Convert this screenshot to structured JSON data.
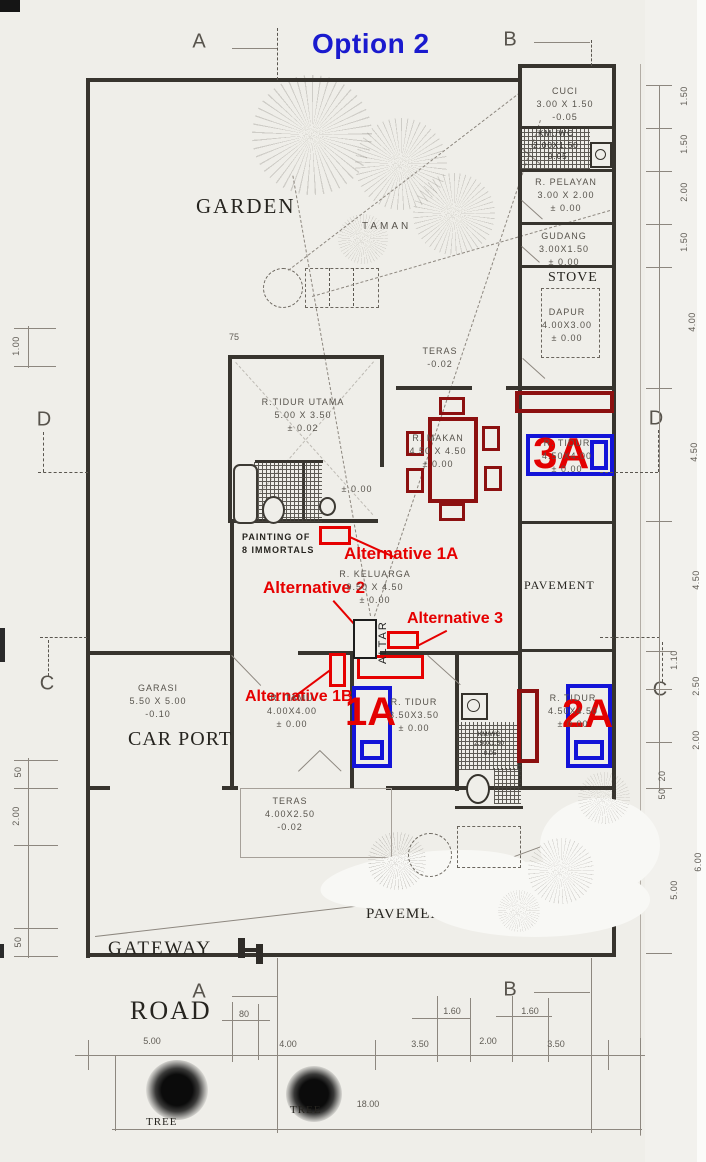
{
  "title": "Option 2",
  "grid": {
    "a_top": "A",
    "b_top": "B",
    "d_left": "D",
    "d_right": "D",
    "c_left": "C",
    "c_right": "C",
    "a_bottom": "A",
    "b_bottom": "B"
  },
  "areas": {
    "garden": "GARDEN",
    "taman": "TAMAN",
    "stove": "STOVE",
    "car_port": "CAR PORT",
    "pavement_right": "PAVEMENT",
    "pavement_bottom": "PAVEMENT",
    "gateway": "GATEWAY",
    "road": "ROAD",
    "tree_1": "TREE",
    "tree_2": "TREE"
  },
  "rooms": {
    "cuci": [
      "CUCI",
      "3.00 X 1.50",
      "-0.05"
    ],
    "kmwc_top": [
      "KM./WC",
      "2.00X1.50",
      "-0.05"
    ],
    "pelayan": [
      "R. PELAYAN",
      "3.00 X 2.00",
      "± 0.00"
    ],
    "gudang": [
      "GUDANG",
      "3.00X1.50",
      "± 0.00"
    ],
    "dapur": [
      "DAPUR",
      "4.00X3.00",
      "± 0.00"
    ],
    "teras_top": [
      "TERAS",
      "-0.02"
    ],
    "tidur_utama": [
      "R.TIDUR UTAMA",
      "5.00 X 3.50",
      "± 0.02"
    ],
    "makan": [
      "R. MAKAN",
      "4.50 X 4.50",
      "± 0.00"
    ],
    "tidur_3a": [
      "R. TIDUR",
      "4.50X4.00",
      "± 0.00"
    ],
    "keluarga": [
      "R. KELUARGA",
      "9.50 X 4.50",
      "± 0.00"
    ],
    "garasi": [
      "GARASI",
      "5.50 X 5.00",
      "-0.10"
    ],
    "tamu": [
      "R. TAMU",
      "4.00X4.00",
      "± 0.00"
    ],
    "tidur_1a": [
      "R. TIDUR",
      "3.50X3.50",
      "± 0.00"
    ],
    "tidur_2a": [
      "R. TIDUR",
      "4.50X4.50",
      "± 0.00"
    ],
    "teras_bottom": [
      "TERAS",
      "4.00X2.50",
      "-0.02"
    ],
    "kmwc_mid": [
      "KM/WC",
      "2.50X1.50",
      "-0.05"
    ],
    "hall_level": "± 0.00"
  },
  "annotations": {
    "alt_1a": "Alternative 1A",
    "alt_2": "Alternative 2",
    "alt_3": "Alternative 3",
    "alt_1b": "Alternative 1B",
    "painting_1": "PAINTING OF",
    "painting_2": "8 IMMORTALS",
    "altar": "ALTAR"
  },
  "markers": {
    "m_1a": "1A",
    "m_2a": "2A",
    "m_3a": "3A"
  },
  "dims": {
    "right": [
      "1.50",
      "1.50",
      "2.00",
      "1.50",
      "4.00",
      "4.50",
      "4.50",
      "1.10",
      "2.50",
      "2.00",
      "20",
      "50",
      "6.00",
      "5.00"
    ],
    "left": [
      "1.00",
      "50",
      "2.00",
      "50"
    ],
    "bottom_upper": [
      "80",
      "1.60",
      "1.60"
    ],
    "bottom_lower": [
      "5.00",
      "4.00",
      "3.50",
      "2.00",
      "3.50"
    ],
    "total_width": "18.00",
    "misc": [
      "75"
    ]
  },
  "colors": {
    "annotation_red": "#e60000",
    "furniture_red": "#8c1010",
    "bed_blue": "#1313d8",
    "title_blue": "#1a1ace"
  }
}
